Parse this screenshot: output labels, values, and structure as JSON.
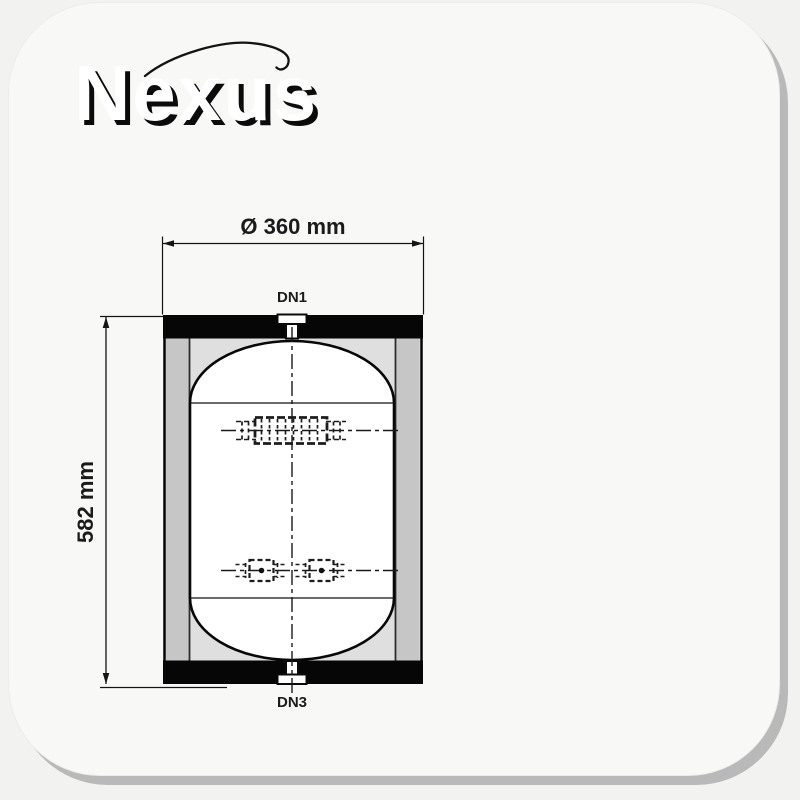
{
  "brand": {
    "name": "Nexus"
  },
  "drawing": {
    "diameter_label": "Ø 360 mm",
    "height_label": "582 mm",
    "top_nozzle_label": "DN1",
    "bottom_nozzle_label": "DN3"
  },
  "colors": {
    "card_background": "#f8f8f6",
    "card_shadow": "#b9b9b9",
    "tank_band_black": "#060606",
    "jacket_gray": "#c6c6c6",
    "insulation_gray": "#dfdfdf",
    "vessel_white": "#ffffff",
    "line_color": "#141414"
  }
}
